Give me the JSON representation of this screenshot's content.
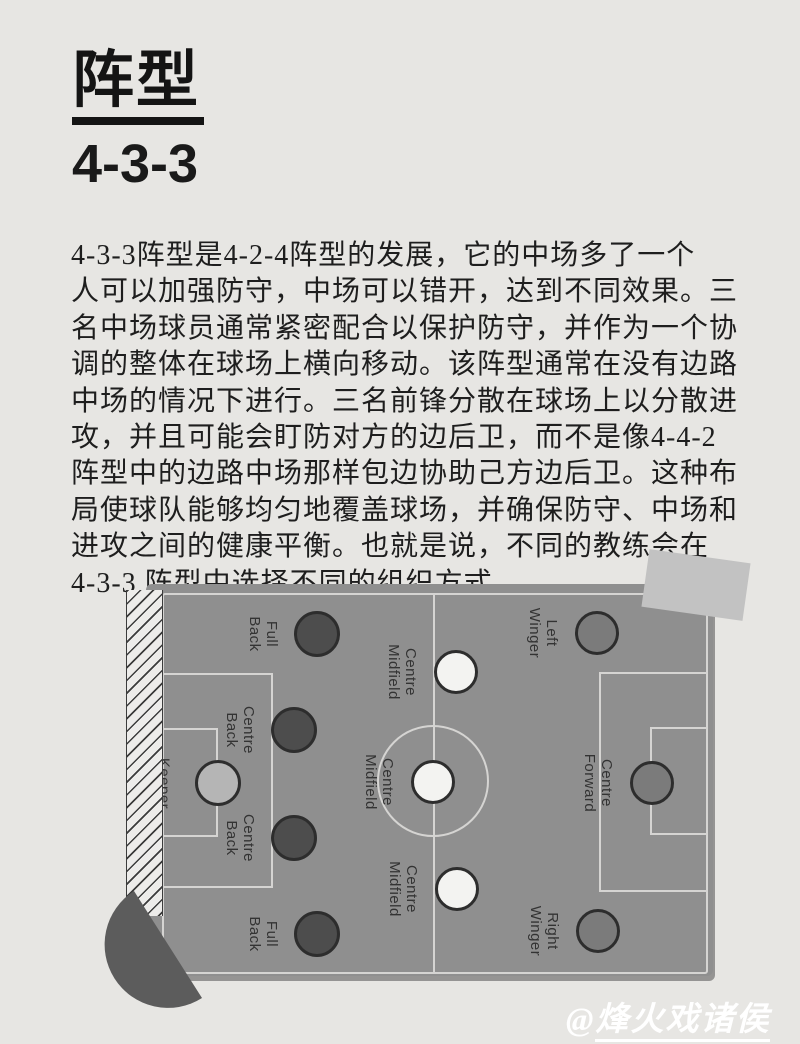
{
  "page": {
    "background": "#e7e6e3"
  },
  "header": {
    "title": "阵型",
    "formation": "4-3-3"
  },
  "article": {
    "lines": [
      "4-3-3阵型是4-2-4阵型的发展，它的中场多了一个",
      "人可以加强防守，中场可以错开，达到不同效果。三",
      "名中场球员通常紧密配合以保护防守，并作为一个协",
      "调的整体在球场上横向移动。该阵型通常在没有边路",
      "中场的情况下进行。三名前锋分散在球场上以分散进",
      "攻，并且可能会盯防对方的边后卫，而不是像4-4-2",
      "阵型中的边路中场那样包边协助己方边后卫。这种布",
      "局使球队能够均匀地覆盖球场，并确保防守、中场和",
      "进攻之间的健康平衡。也就是说，不同的教练会在",
      "4-3-3 阵型中选择不同的组织方式。"
    ]
  },
  "diagram": {
    "colors": {
      "pitch": "#8f8f8f",
      "lines": "#d5d4d2",
      "defender": "#4d4d4d",
      "keeper": "#b5b5b5",
      "midfielder": "#f3f3f1",
      "forward": "#7b7b7b",
      "decoration_dark": "#5c5c5c",
      "tape": "#c2c2c2"
    },
    "players": [
      {
        "role": "keeper",
        "lines": [
          "Keeper"
        ],
        "x": 72,
        "y": 199,
        "r": 23,
        "fill": "#b5b5b5"
      },
      {
        "role": "full-back-top",
        "lines": [
          "Full",
          "Back"
        ],
        "x": 171,
        "y": 50,
        "r": 23,
        "fill": "#4d4d4d"
      },
      {
        "role": "centre-back-top",
        "lines": [
          "Centre",
          "Back"
        ],
        "x": 148,
        "y": 146,
        "r": 23,
        "fill": "#4d4d4d"
      },
      {
        "role": "centre-back-bottom",
        "lines": [
          "Centre",
          "Back"
        ],
        "x": 148,
        "y": 254,
        "r": 23,
        "fill": "#4d4d4d"
      },
      {
        "role": "full-back-bottom",
        "lines": [
          "Full",
          "Back"
        ],
        "x": 171,
        "y": 350,
        "r": 23,
        "fill": "#4d4d4d"
      },
      {
        "role": "centre-midfield-top",
        "lines": [
          "Centre",
          "Midfield"
        ],
        "x": 310,
        "y": 88,
        "r": 22,
        "fill": "#f3f3f1"
      },
      {
        "role": "centre-midfield-middle",
        "lines": [
          "Centre",
          "Midfield"
        ],
        "x": 287,
        "y": 198,
        "r": 22,
        "fill": "#f3f3f1"
      },
      {
        "role": "centre-midfield-bottom",
        "lines": [
          "Centre",
          "Midfield"
        ],
        "x": 311,
        "y": 305,
        "r": 22,
        "fill": "#f3f3f1"
      },
      {
        "role": "left-winger",
        "lines": [
          "Left",
          "Winger"
        ],
        "x": 451,
        "y": 49,
        "r": 22,
        "fill": "#7b7b7b"
      },
      {
        "role": "centre-forward",
        "lines": [
          "Centre",
          "Forward"
        ],
        "x": 506,
        "y": 199,
        "r": 22,
        "fill": "#7b7b7b"
      },
      {
        "role": "right-winger",
        "lines": [
          "Right",
          "Winger"
        ],
        "x": 452,
        "y": 347,
        "r": 22,
        "fill": "#7b7b7b"
      }
    ]
  },
  "watermark": {
    "prefix": "@",
    "name": "烽火戏诸侯"
  }
}
